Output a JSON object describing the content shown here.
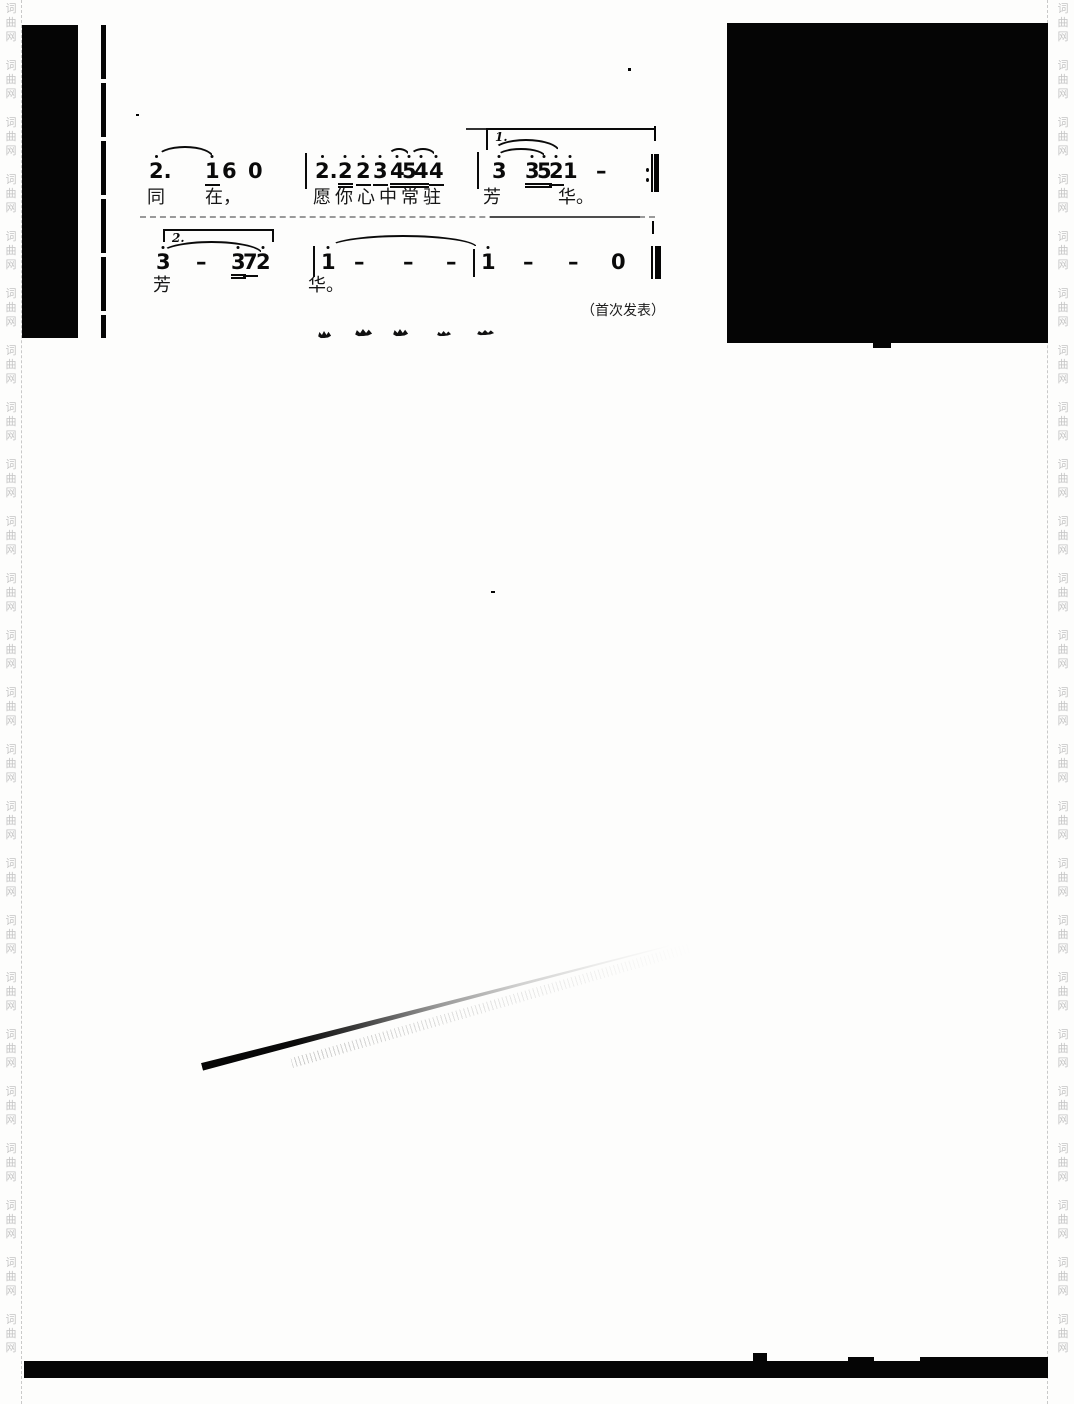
{
  "page": {
    "width": 1074,
    "height": 1404,
    "background": "#fdfdfc",
    "ink": "#0a0a0a"
  },
  "watermark": {
    "chars": [
      "词",
      "曲",
      "网"
    ],
    "groups": 24,
    "color": "#c4c4c4",
    "left_x": 2,
    "right_x": 1054
  },
  "margins": {
    "left_dash_x": 21,
    "right_dash_x": 1047
  },
  "artifacts": {
    "blocks": [
      {
        "name": "left-black-block",
        "x": 22,
        "y": 25,
        "w": 56,
        "h": 313
      },
      {
        "name": "right-black-block",
        "x": 727,
        "y": 23,
        "w": 321,
        "h": 320
      },
      {
        "name": "right-block-bottom-bump",
        "x": 873,
        "y": 342,
        "w": 18,
        "h": 6
      },
      {
        "name": "bottom-black-bar",
        "x": 24,
        "y": 1361,
        "w": 1024,
        "h": 17
      },
      {
        "name": "bottom-bar-bump-1",
        "x": 753,
        "y": 1353,
        "w": 14,
        "h": 9
      },
      {
        "name": "bottom-bar-bump-2",
        "x": 848,
        "y": 1357,
        "w": 26,
        "h": 5
      },
      {
        "name": "bottom-bar-top-strip",
        "x": 920,
        "y": 1357,
        "w": 128,
        "h": 5
      },
      {
        "name": "volta1-right-tick",
        "x": 654,
        "y": 126,
        "w": 2,
        "h": 15
      },
      {
        "name": "separator-right-tick",
        "x": 652,
        "y": 221,
        "w": 2,
        "h": 13
      },
      {
        "name": "speck-1",
        "x": 628,
        "y": 68,
        "w": 3,
        "h": 3
      },
      {
        "name": "speck-2",
        "x": 491,
        "y": 591,
        "w": 4,
        "h": 2
      },
      {
        "name": "speck-3",
        "x": 136,
        "y": 114,
        "w": 3,
        "h": 2
      }
    ],
    "broken_vline": {
      "name": "left-thin-rule",
      "x": 101,
      "y": 25,
      "w": 5,
      "h": 313
    },
    "fragments": [
      {
        "x": 318,
        "y": 331,
        "w": 13,
        "h": 7
      },
      {
        "x": 355,
        "y": 329,
        "w": 17,
        "h": 7
      },
      {
        "x": 393,
        "y": 329,
        "w": 15,
        "h": 7
      },
      {
        "x": 437,
        "y": 331,
        "w": 14,
        "h": 5
      },
      {
        "x": 477,
        "y": 330,
        "w": 17,
        "h": 5
      }
    ],
    "streak": {
      "x": 203,
      "y": 1062,
      "w": 485,
      "h": 9,
      "angle": -14.5
    }
  },
  "score": {
    "note_font_size": 21,
    "systems": [
      {
        "name": "system-1",
        "note_y": 161,
        "lyric_y": 189,
        "volta": {
          "label": "1.",
          "x": 486,
          "y": 128,
          "w": 170,
          "left_hook": true,
          "right_hook": false,
          "hook_h": 22
        },
        "pre_lines": [
          {
            "x": 466,
            "y": 128,
            "w": 22
          }
        ],
        "notes": [
          {
            "t": "2.",
            "x": 149,
            "da": 1,
            "ddx": 6
          },
          {
            "t": "1",
            "x": 205,
            "da": 1,
            "ul": 1
          },
          {
            "t": "6",
            "x": 222
          },
          {
            "t": "0",
            "x": 248
          },
          {
            "t": "2.",
            "x": 315,
            "da": 1,
            "ddx": 6
          },
          {
            "t": "2",
            "x": 338,
            "da": 1,
            "ul": 2
          },
          {
            "t": "2",
            "x": 356,
            "da": 1,
            "ul": 1
          },
          {
            "t": "3",
            "x": 373,
            "da": 1,
            "ul": 1
          },
          {
            "t": "4",
            "x": 390,
            "da": 1,
            "ul": 2
          },
          {
            "t": "5",
            "x": 402,
            "da": 1,
            "ul": 2
          },
          {
            "t": "4",
            "x": 414,
            "da": 1,
            "ul": 2
          },
          {
            "t": "4",
            "x": 429,
            "da": 1,
            "ul": 1
          },
          {
            "t": "3",
            "x": 492,
            "da": 1
          },
          {
            "t": "3",
            "x": 525,
            "da": 1,
            "ul": 2
          },
          {
            "t": "5",
            "x": 537,
            "da": 1,
            "ul": 2
          },
          {
            "t": "2",
            "x": 549,
            "da": 1,
            "ul": 1
          },
          {
            "t": "1",
            "x": 563,
            "da": 1
          },
          {
            "t": "–",
            "x": 596
          }
        ],
        "bars": [
          {
            "x": 305,
            "y": 153,
            "h": 36
          },
          {
            "x": 477,
            "y": 152,
            "h": 37
          }
        ],
        "slurs": [
          {
            "x": 156,
            "y": 146,
            "w": 58,
            "h": 12
          },
          {
            "x": 388,
            "y": 148,
            "w": 22,
            "h": 8
          },
          {
            "x": 410,
            "y": 148,
            "w": 26,
            "h": 8
          },
          {
            "x": 492,
            "y": 139,
            "w": 68,
            "h": 13
          },
          {
            "x": 496,
            "y": 148,
            "w": 50,
            "h": 9
          }
        ],
        "repeat_dots": [
          {
            "x": 646,
            "y": 168
          },
          {
            "x": 646,
            "y": 178
          }
        ],
        "end_bar": {
          "thin_x": 651,
          "thin_w": 2,
          "thick_x": 654,
          "thick_w": 5,
          "y": 154,
          "h": 38
        },
        "lyrics": [
          {
            "t": "同",
            "x": 147
          },
          {
            "t": "在，",
            "x": 205
          },
          {
            "t": "愿你心中常驻",
            "x": 313,
            "ls": 4
          },
          {
            "t": "芳",
            "x": 483
          },
          {
            "t": "华。",
            "x": 558
          }
        ]
      },
      {
        "name": "system-2",
        "note_y": 252,
        "lyric_y": 277,
        "separator": {
          "x": 140,
          "y": 216,
          "w": 515,
          "dark_x": 490,
          "dark_w": 150
        },
        "volta": {
          "label": "2.",
          "x": 163,
          "y": 229,
          "w": 111,
          "left_hook": true,
          "right_hook": true,
          "hook_h": 13
        },
        "pre_lines": [],
        "notes": [
          {
            "t": "3",
            "x": 156,
            "da": 1
          },
          {
            "t": "–",
            "x": 196
          },
          {
            "t": "3",
            "x": 231,
            "da": 1,
            "ul": 2
          },
          {
            "t": "7",
            "x": 243,
            "ul": 1
          },
          {
            "t": "2",
            "x": 256,
            "da": 1
          },
          {
            "t": "1",
            "x": 321,
            "da": 1
          },
          {
            "t": "–",
            "x": 354
          },
          {
            "t": "–",
            "x": 403
          },
          {
            "t": "–",
            "x": 446
          },
          {
            "t": "1",
            "x": 481,
            "da": 1
          },
          {
            "t": "–",
            "x": 523
          },
          {
            "t": "–",
            "x": 568
          },
          {
            "t": "0",
            "x": 611
          }
        ],
        "bars": [
          {
            "x": 313,
            "y": 246,
            "h": 31
          },
          {
            "x": 473,
            "y": 249,
            "h": 28
          }
        ],
        "slurs": [
          {
            "x": 160,
            "y": 241,
            "w": 103,
            "h": 13
          },
          {
            "x": 328,
            "y": 235,
            "w": 150,
            "h": 13
          }
        ],
        "repeat_dots": [],
        "end_bar": {
          "thin_x": 651,
          "thin_w": 2,
          "thick_x": 655,
          "thick_w": 6,
          "y": 246,
          "h": 33
        },
        "lyrics": [
          {
            "t": "芳",
            "x": 153
          },
          {
            "t": "华。",
            "x": 308
          }
        ]
      }
    ],
    "credit": {
      "text": "（首次发表）",
      "x": 581,
      "y": 303,
      "font_size": 14
    }
  }
}
